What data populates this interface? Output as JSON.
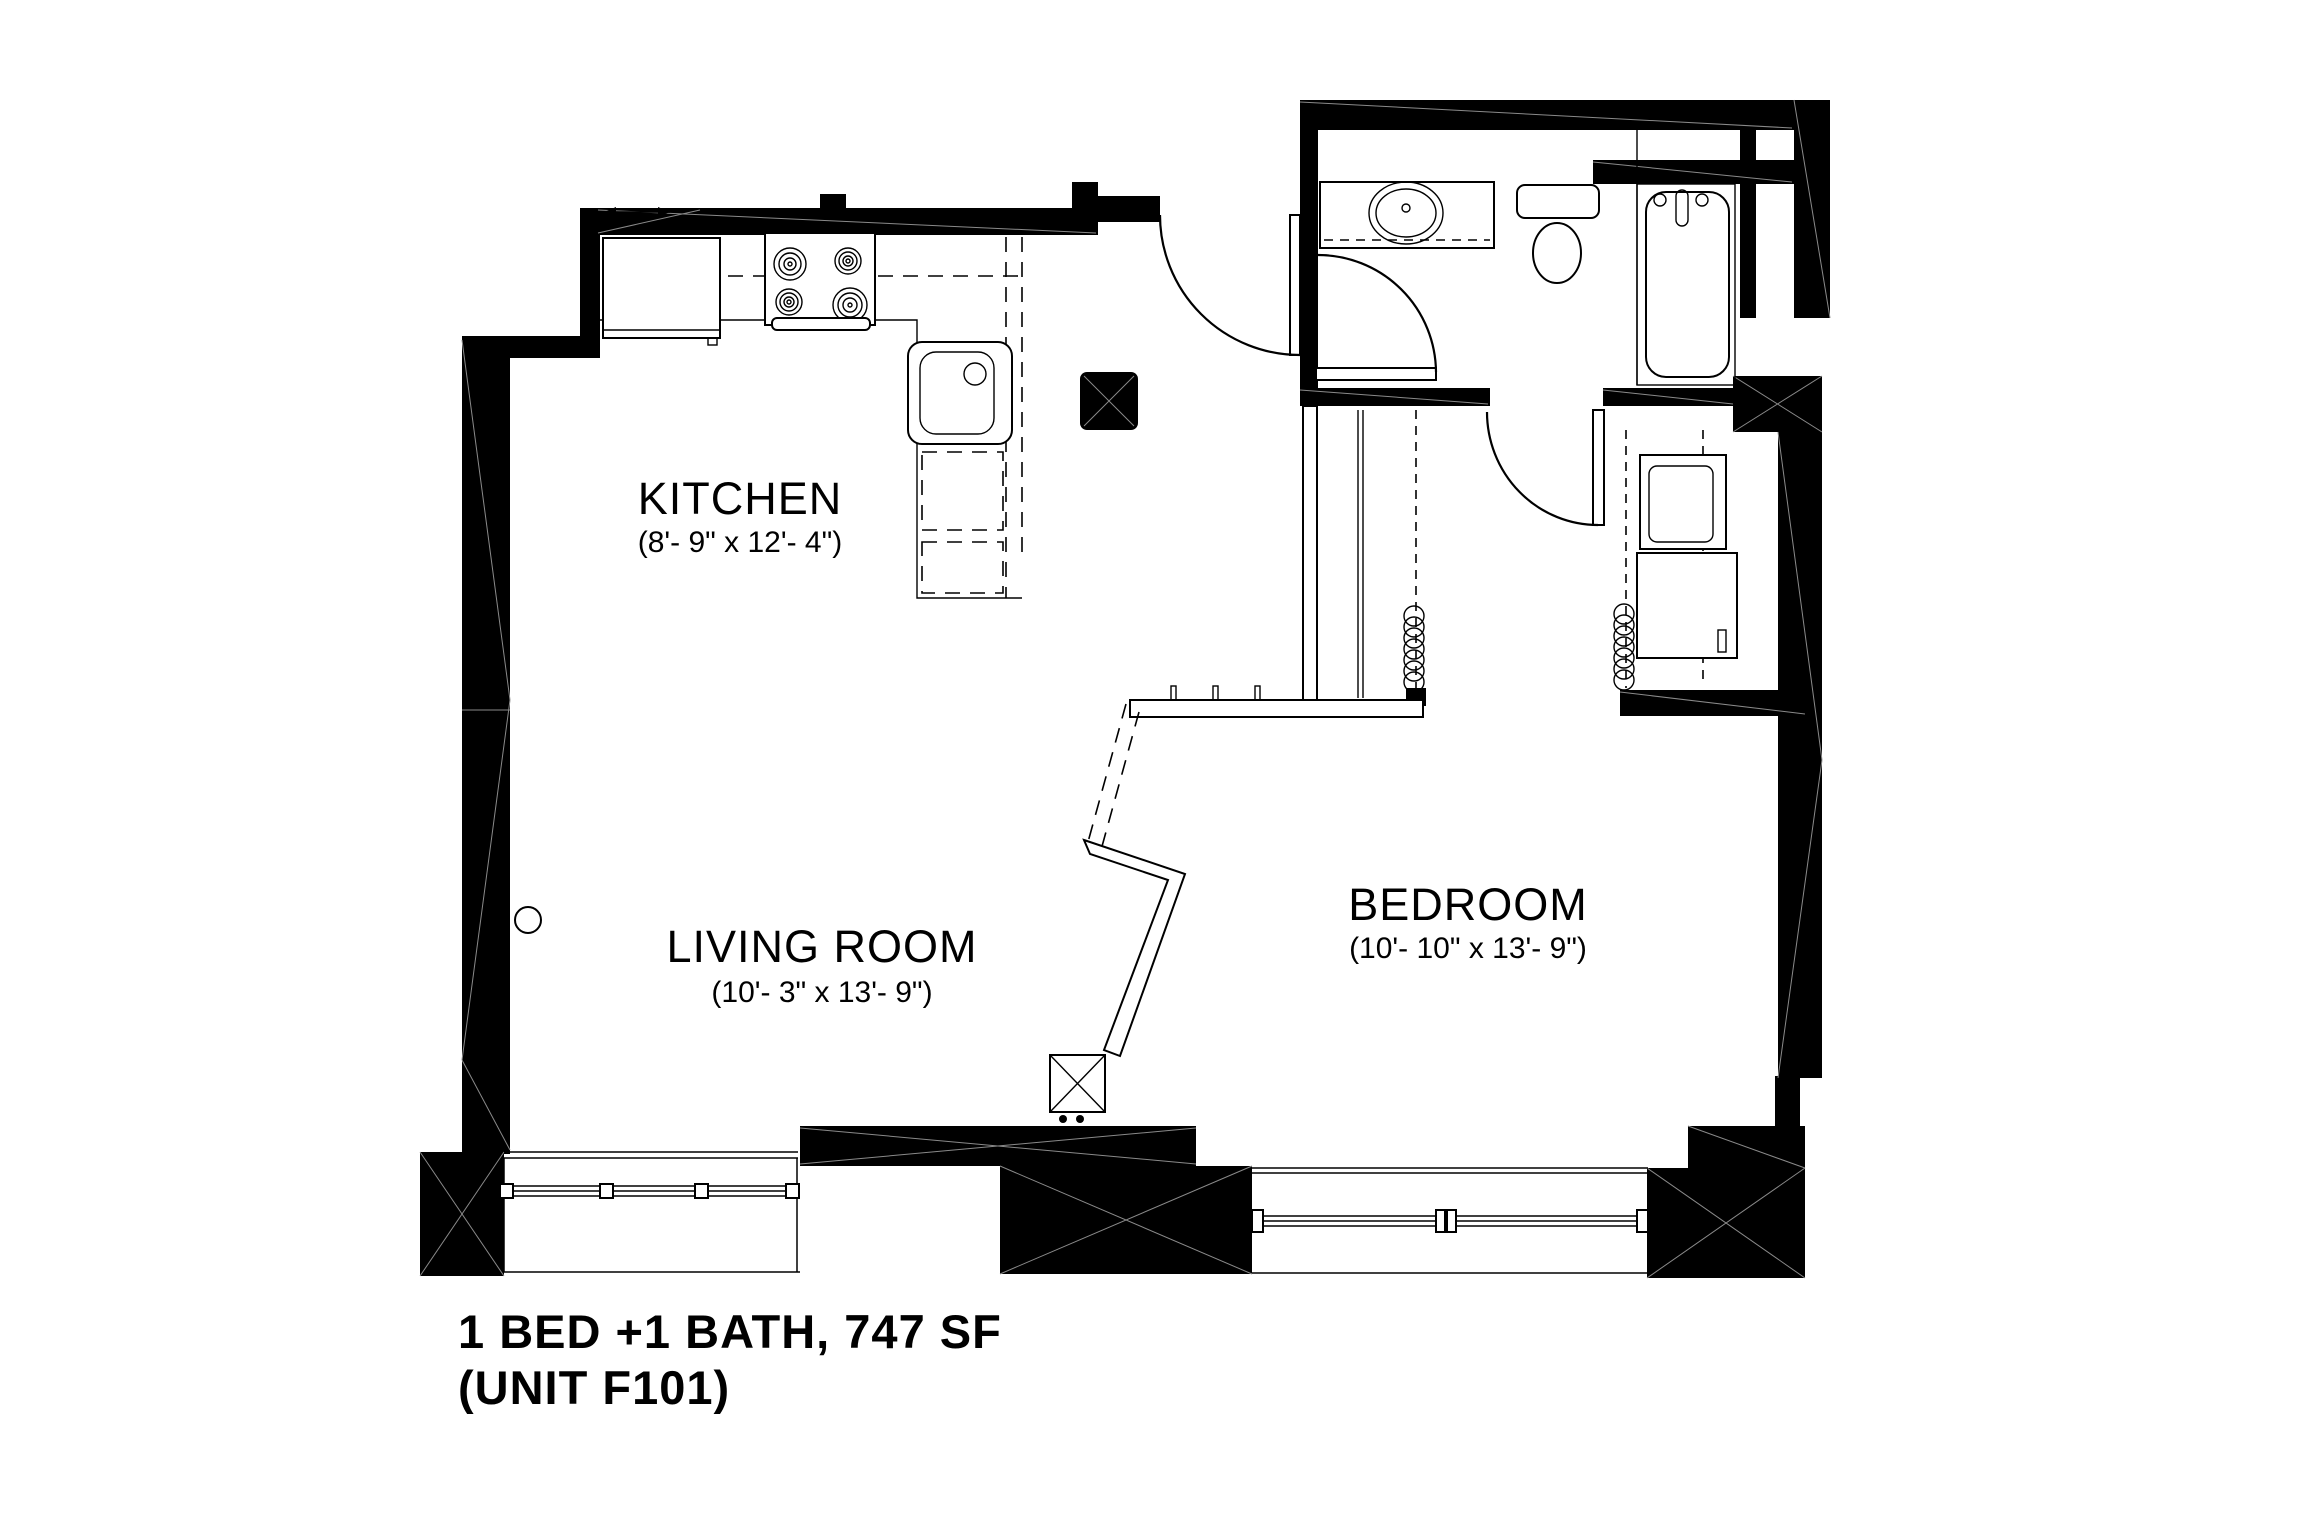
{
  "title": {
    "line1": "1 BED +1 BATH, 747 SF",
    "line2": "(UNIT F101)"
  },
  "rooms": {
    "kitchen": {
      "name": "KITCHEN",
      "dims": "(8'- 9\" x 12'- 4\")"
    },
    "living_room": {
      "name": "LIVING ROOM",
      "dims": "(10'- 3\" x 13'- 9\")"
    },
    "bedroom": {
      "name": "BEDROOM",
      "dims": "(10'- 10\" x 13'- 9\")"
    }
  },
  "fixtures": {
    "refrigerator": "refrigerator",
    "range": "range-4-burner",
    "kitchen_sink": "kitchen-sink",
    "vanity_sink": "vanity-oval-sink",
    "toilet": "toilet",
    "bathtub": "bathtub-with-faucet",
    "washer_dryer": "stacked-washer-dryer",
    "closet_rods": "closet-rod-with-hangers",
    "mechanical": "mechanical-chase-x-box",
    "entry_door": "entry-door-swing",
    "bathroom_door": "bathroom-door-swing",
    "bedroom_door": "bedroom-door-swing",
    "windows": "window-glazing-with-mullions"
  },
  "colors": {
    "background": "#ffffff",
    "wall": "#000000",
    "line": "#000000",
    "brace": "#8a8a8a"
  }
}
